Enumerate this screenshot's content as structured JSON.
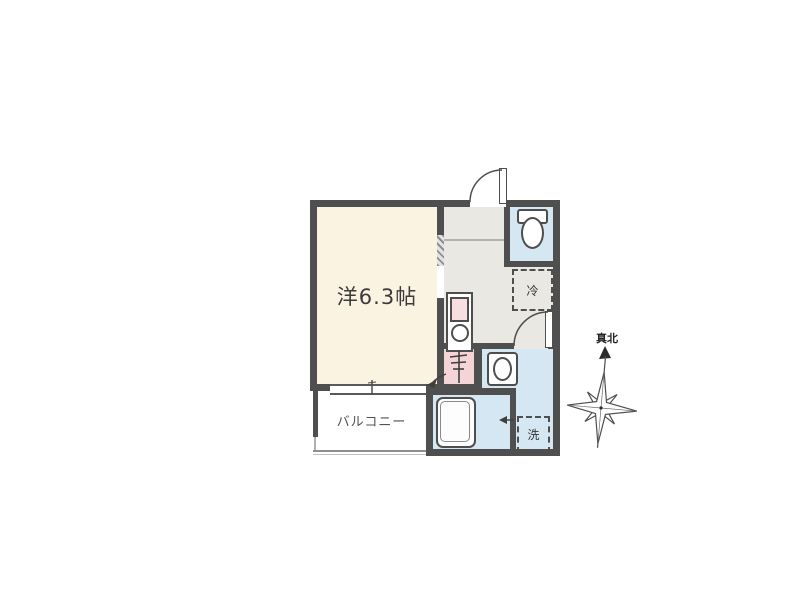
{
  "labels": {
    "main_room": "洋6.3帖",
    "balcony": "バルコニー",
    "refrigerator": "冷",
    "washer": "洗",
    "true_north": "真北"
  },
  "colors": {
    "background": "#ffffff",
    "wall": "#4f4f4f",
    "room_floor": "#fbf3e2",
    "hall_floor": "#e9e8e3",
    "water_floor": "#d5e7f2",
    "pink": "#f5d4d8"
  },
  "fixtures": [
    "entrance-door",
    "toilet",
    "refrigerator-space",
    "kitchen-sink-unit",
    "water-heater",
    "washbasin",
    "bathtub",
    "washer-space",
    "washroom-door",
    "bath-door",
    "balcony-window",
    "compass-rose"
  ]
}
